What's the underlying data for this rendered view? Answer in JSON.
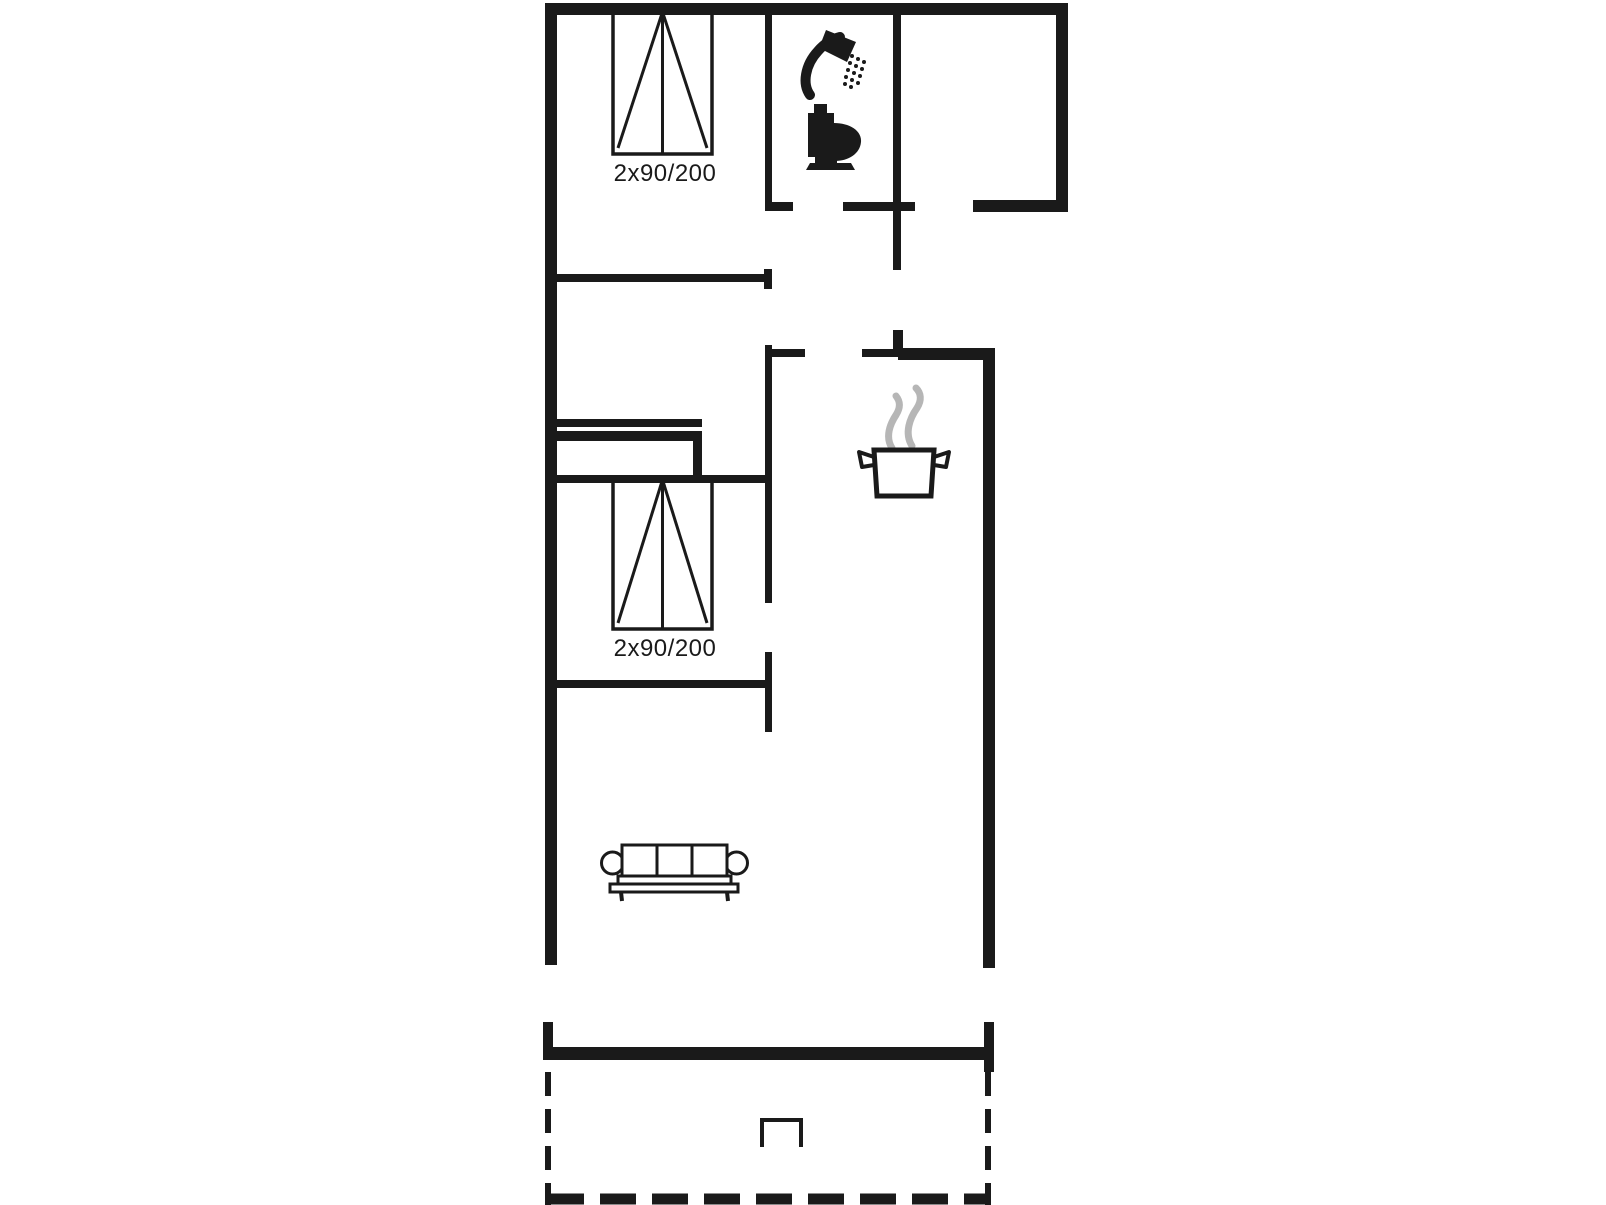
{
  "plan": {
    "background": "#ffffff",
    "line_color": "#1a1a1a",
    "steam_color": "#b6b6b6",
    "beds": [
      {
        "label": "2x90/200",
        "x": 613,
        "y": 12,
        "w": 99,
        "h": 142,
        "label_x": 665,
        "label_y": 181
      },
      {
        "label": "2x90/200",
        "x": 613,
        "y": 480,
        "w": 99,
        "h": 149,
        "label_x": 665,
        "label_y": 656
      }
    ],
    "walls": [
      [
        545,
        3,
        523,
        12
      ],
      [
        545,
        3,
        12,
        962
      ],
      [
        1056,
        3,
        12,
        209
      ],
      [
        973,
        200,
        95,
        12
      ],
      [
        843,
        202,
        72,
        9
      ],
      [
        893,
        3,
        8,
        267
      ],
      [
        765,
        3,
        7,
        205
      ],
      [
        765,
        202,
        28,
        9
      ],
      [
        548,
        274,
        218,
        8
      ],
      [
        764,
        269,
        8,
        20
      ],
      [
        765,
        345,
        7,
        258
      ],
      [
        772,
        349,
        33,
        8
      ],
      [
        765,
        652,
        7,
        80
      ],
      [
        548,
        475,
        220,
        8
      ],
      [
        548,
        680,
        220,
        8
      ],
      [
        862,
        349,
        36,
        8
      ],
      [
        898,
        348,
        97,
        12
      ],
      [
        893,
        330,
        10,
        20
      ],
      [
        983,
        348,
        12,
        620
      ],
      [
        543,
        1022,
        10,
        38
      ],
      [
        547,
        1047,
        441,
        13
      ],
      [
        984,
        1022,
        10,
        50
      ]
    ],
    "dashed_lines": [
      {
        "x1": 548,
        "y1": 1072,
        "x2": 548,
        "y2": 1205,
        "width": 6,
        "dash": "24 13"
      },
      {
        "x1": 988,
        "y1": 1072,
        "x2": 988,
        "y2": 1205,
        "width": 6,
        "dash": "24 13"
      },
      {
        "x1": 548,
        "y1": 1199,
        "x2": 990,
        "y2": 1199,
        "width": 11,
        "dash": "36 16"
      }
    ],
    "wardrobe_bars": [
      [
        550,
        419,
        152,
        8
      ],
      [
        550,
        431,
        152,
        10
      ],
      [
        693,
        431,
        9,
        50
      ],
      [
        550,
        477,
        152,
        4
      ]
    ],
    "icons": [
      {
        "name": "shower-icon"
      },
      {
        "name": "toilet-icon"
      },
      {
        "name": "cooking-pot-icon"
      },
      {
        "name": "steam-icon"
      },
      {
        "name": "sofa"
      },
      {
        "name": "double-bed"
      },
      {
        "name": "double-bed"
      },
      {
        "name": "wardrobe"
      },
      {
        "name": "terrace-step"
      }
    ]
  }
}
